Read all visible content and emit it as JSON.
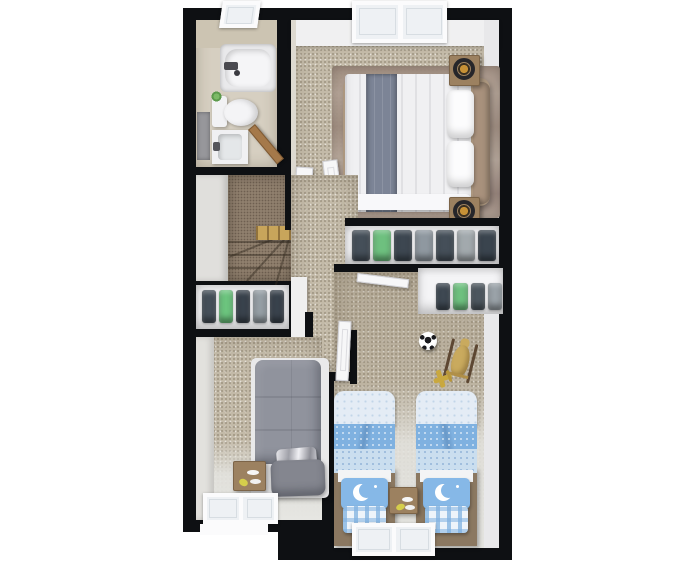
{
  "meta": {
    "type": "3d-floor-plan-render",
    "view": "top-down dollhouse",
    "floor_label": "upper floor",
    "canvas_w": 696,
    "canvas_h": 568
  },
  "palette": {
    "wall_black": "#0e1013",
    "margin_white": "#ffffff",
    "carpet_beige": "#c3baa8",
    "light_floor": "#e4e4e0",
    "bathroom_tile": "#d6cfc1",
    "stairs_brown": "#8f7f6d",
    "stair_wood": "#c8a55b",
    "rug_mauve": "#a79686",
    "bed_white": "#f0f0f2",
    "bed_runner_gray": "#7c8496",
    "headboard_tan": "#a8917c",
    "nightstand_wood": "#9c8160",
    "lamp_gold": "#c79136",
    "gray_bed": "#90939d",
    "kids_blue_mid": "#7fb1e0",
    "kids_blue_light": "#e4ecf5",
    "kids_blue_dots": "#cadeef",
    "moon_pillow_blue": "#86b8e7",
    "platform_brown": "#8b7861",
    "clothes_green": "#6ec07f",
    "toy_yellow": "#d5ce4b",
    "toy_wood": "#c9aa5e"
  },
  "clothes": {
    "hall_closet": [
      "#454f59",
      "#6cc47e",
      "#39424c",
      "#959ea4",
      "#39424c"
    ],
    "master_closet": [
      "#454f59",
      "#6ec07f",
      "#3d4751",
      "#8f98a0",
      "#454f59",
      "#a2a9ad",
      "#3a444e"
    ],
    "kids_closet": [
      "#3e4852",
      "#6ec07f",
      "#4d575f",
      "#9aa2a8"
    ]
  },
  "rooms": [
    {
      "id": "bathroom",
      "name": "bathroom",
      "furniture": [
        "bathtub",
        "toilet",
        "plant-on-tank",
        "vanity-sink",
        "shower-glass-panel",
        "door",
        "window"
      ]
    },
    {
      "id": "master-bedroom",
      "name": "master bedroom",
      "furniture": [
        "double-bed",
        "gray-throw-runner",
        "two-pillows",
        "headboard",
        "nightstand-with-lamp-top",
        "nightstand-with-lamp-bottom",
        "area-rug",
        "window",
        "door"
      ]
    },
    {
      "id": "stairwell",
      "name": "staircase",
      "furniture": [
        "winder-stairs",
        "wood-steps",
        "door"
      ]
    },
    {
      "id": "hall-closet",
      "name": "hall closet",
      "furniture": [
        "hanging-clothes"
      ]
    },
    {
      "id": "master-closet",
      "name": "master closet",
      "furniture": [
        "hanging-clothes"
      ]
    },
    {
      "id": "bedroom-2",
      "name": "bedroom 2",
      "furniture": [
        "single-bed-gray",
        "gray-pillow",
        "metallic-magazine",
        "nightstand",
        "window"
      ]
    },
    {
      "id": "kids-bedroom",
      "name": "kids bedroom",
      "furniture": [
        "twin-bed-left",
        "twin-bed-right",
        "moon-pillows",
        "plaid-pillows",
        "nightstand",
        "kids-closet-clothes",
        "window",
        "soccer-ball",
        "rocking-horse-toy",
        "toy-plane"
      ]
    }
  ]
}
